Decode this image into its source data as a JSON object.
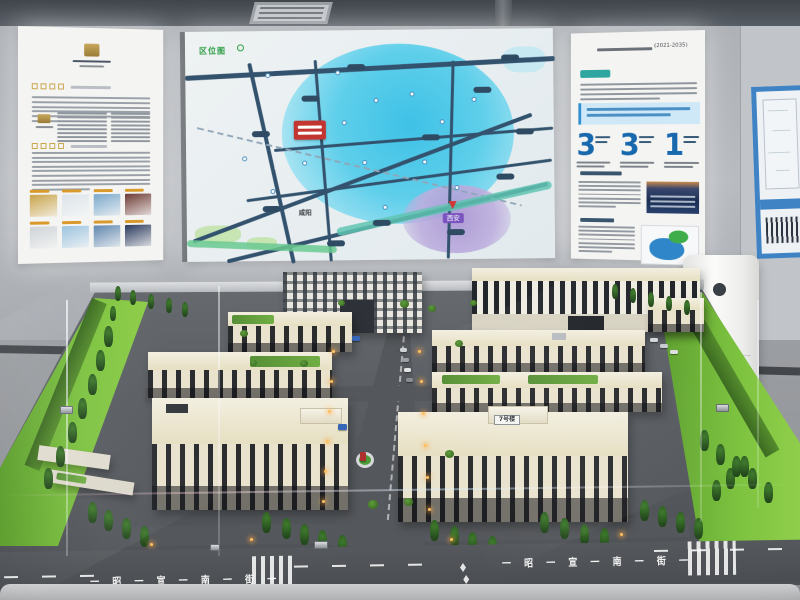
{
  "map_panel": {
    "title_badge": "区位图",
    "city_labels": {
      "xianyang": "咸阳",
      "xian": "西安"
    },
    "marker_color": "#c23531"
  },
  "right_panel": {
    "plan_years": "(2021-2035)",
    "stats": [
      {
        "value": "3"
      },
      {
        "value": "3"
      },
      {
        "value": "1"
      }
    ],
    "number_color": "#1868ae"
  },
  "left_panel": {
    "photo_label_color": "#d99a2b",
    "photo_colors": [
      "#c9a44a",
      "#dce4ea",
      "#7aa8cc",
      "#6e3a34",
      "#cfd4d8",
      "#9cc4e0",
      "#5f87b0",
      "#2a3a5e"
    ]
  },
  "model": {
    "building7_sign": "7号楼",
    "street_name": "昭宣南街",
    "street_text": "一 昭 一 宣 一 南 一 街 一"
  },
  "colors": {
    "wall": "#b2b5ba",
    "floor": "#989ba0",
    "ceiling": "#4e545a",
    "lawn": "#74b93a",
    "platform": "#5a5e63",
    "building": "#e9e2cd",
    "map_water": "#4ec7e4",
    "map_purple": "#b3a0d6"
  }
}
